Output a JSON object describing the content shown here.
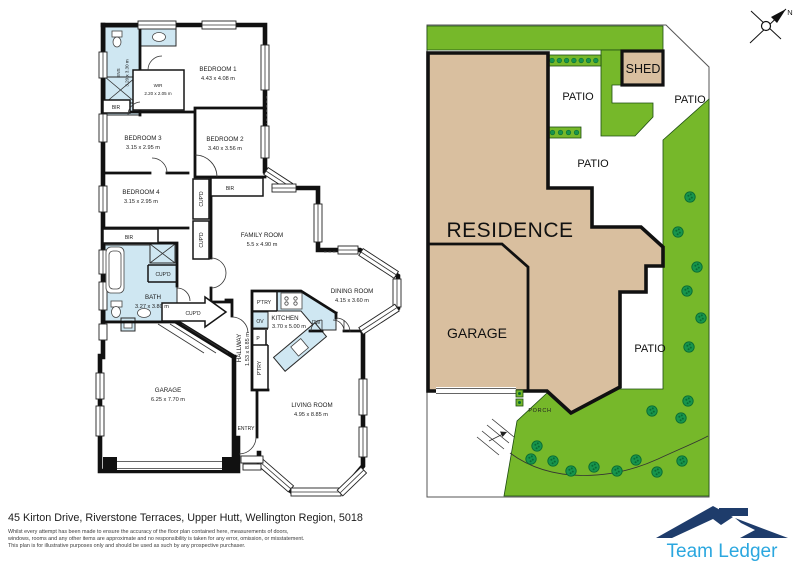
{
  "floorplan": {
    "rooms": [
      {
        "name": "BEDROOM 1",
        "dims": "4.43 x 4.08 m"
      },
      {
        "name": "BEDROOM 2",
        "dims": "3.40 x 3.56 m"
      },
      {
        "name": "BEDROOM 3",
        "dims": "3.15 x 2.95 m"
      },
      {
        "name": "BEDROOM 4",
        "dims": "3.15 x 2.95 m"
      },
      {
        "name": "ENS",
        "dims": "3.20 x 3.30 m"
      },
      {
        "name": "WIR",
        "dims": "2.20 x 2.05 m"
      },
      {
        "name": "FAMILY ROOM",
        "dims": "5.5 x 4.90 m"
      },
      {
        "name": "BATH",
        "dims": "3.27 x 3.80 m"
      },
      {
        "name": "KITCHEN",
        "dims": "3.70 x 5.00 m"
      },
      {
        "name": "DINING ROOM",
        "dims": "4.15 x 3.60 m"
      },
      {
        "name": "HALLWAY",
        "dims": "1.53 x 8.85 m"
      },
      {
        "name": "GARAGE",
        "dims": "6.25 x 7.70 m"
      },
      {
        "name": "LIVING ROOM",
        "dims": "4.95 x 8.85 m"
      }
    ],
    "features": {
      "bir": "BIR",
      "cupd": "CUP'D",
      "pantry": "P'TRY",
      "oven": "OV",
      "pantry_short": "P",
      "dishwasher": "DW",
      "entry": "ENTRY"
    }
  },
  "siteplan": {
    "residence": "RESIDENCE",
    "garage": "GARAGE",
    "shed": "SHED",
    "patio": "PATIO",
    "porch": "PORCH"
  },
  "compass": {
    "north": "N"
  },
  "footer": {
    "address": "45 Kirton Drive, Riverstone Terraces, Upper Hutt, Wellington Region, 5018",
    "disclaimer_line1": "Whilst every attempt has been made to ensure the accuracy of the floor plan contained here, measurements of doors,",
    "disclaimer_line2": "windows, rooms and any other items are approximate and no responsibility is taken for any error, omission, or misstatement.",
    "disclaimer_line3": "This plan is for illustrative purposes only and should be used as such by any prospective purchaser."
  },
  "branding": {
    "company": "Team Ledger"
  },
  "colors": {
    "grass_green": "#76b82a",
    "bush_green": "#17954d",
    "building_tan": "#d9bf9f",
    "wet_area_blue": "#cfe7f2",
    "wall_black": "#111111",
    "logo_navy": "#1e3c6b",
    "logo_blue": "#2ba7df"
  }
}
